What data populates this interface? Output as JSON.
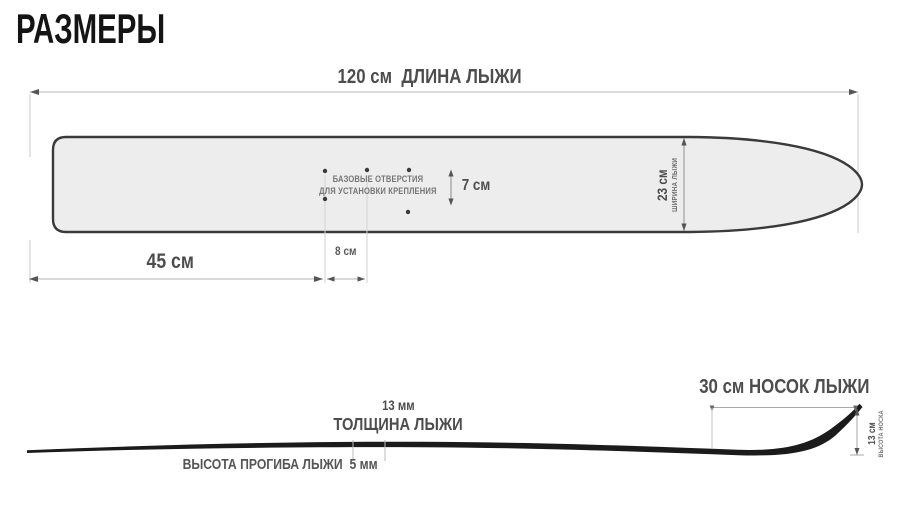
{
  "title": "РАЗМЕРЫ",
  "top_view": {
    "length_dim": "120 см  ДЛИНА ЛЫЖИ",
    "holes_note": [
      "БАЗОВЫЕ ОТВЕРСТИЯ",
      "ДЛЯ УСТАНОВКИ КРЕПЛЕНИЯ"
    ],
    "holes_gap_dim": "7 см",
    "width_value": "23 см",
    "width_caption": "ШИРИНА ЛЫЖИ",
    "tail_to_holes_dim": "45 см",
    "hole_spacing_dim": "8 см"
  },
  "side_view": {
    "thickness_value": "13 мм",
    "thickness_caption": "ТОЛЩИНА ЛЫЖИ",
    "camber_dim": "ВЫСОТА ПРОГИБА ЛЫЖИ  5 мм",
    "tip_dim": "30 см НОСОК ЛЫЖИ",
    "tip_height_value": "13 см",
    "tip_height_caption": "ВЫСОТА НОСКА"
  },
  "measurements": {
    "ski_length_cm": 120,
    "ski_width_cm": 23,
    "holes_gap_cm": 7,
    "tail_to_holes_cm": 45,
    "hole_spacing_cm": 8,
    "thickness_mm": 13,
    "camber_height_mm": 5,
    "tip_length_cm": 30,
    "tip_height_cm": 13
  },
  "colors": {
    "background": "#ffffff",
    "title": "#141414",
    "label_dark": "#4d4d4d",
    "label_light": "#6f6f6f",
    "dim_line": "#b0b0b0",
    "arrow": "#555555",
    "ski_fill": "#ededed",
    "ski_outline": "#3a3a3a",
    "side_profile": "#1b1b1b"
  }
}
